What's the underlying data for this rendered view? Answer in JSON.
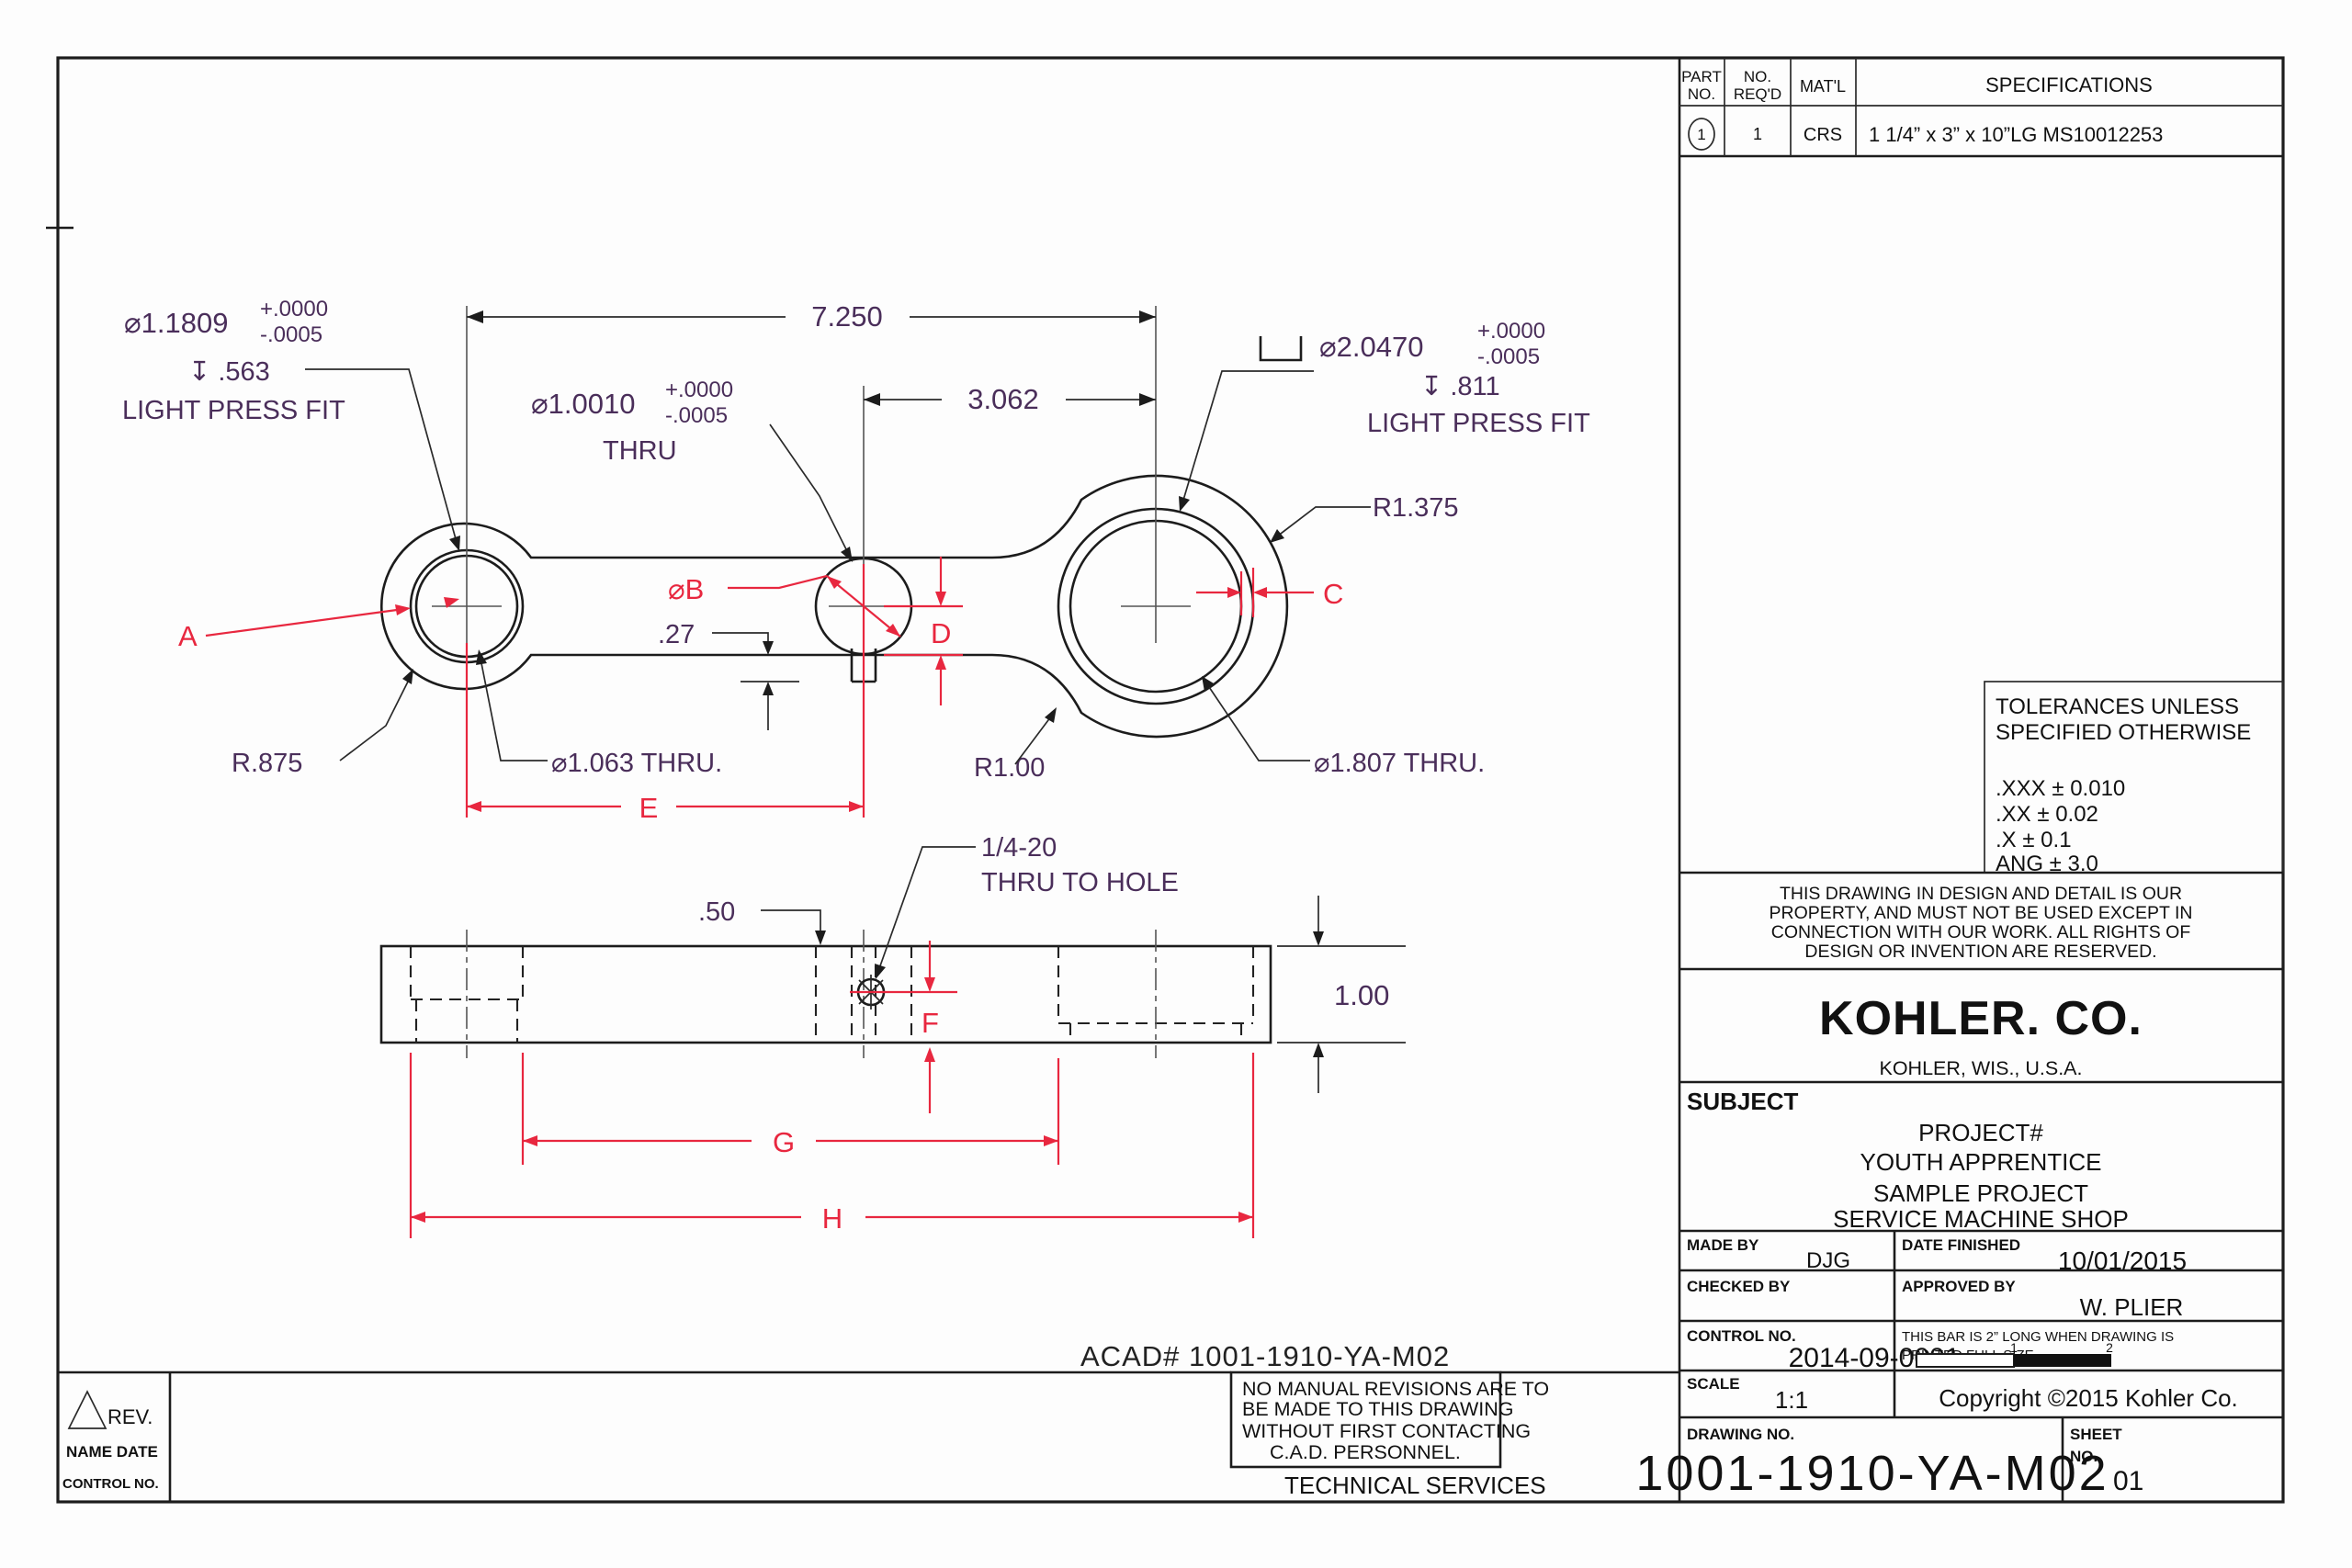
{
  "colors": {
    "dim_text": "#4a2e5a",
    "red_accent": "#e8273f",
    "line": "#1c1c1c"
  },
  "tv": {
    "d7250": "7.250",
    "d3062": "3.062",
    "bl": {
      "dia": "⌀1.1809",
      "tp": "+.0000",
      "tm": "-.0005",
      "depth": "↧ .563",
      "fit": "LIGHT PRESS FIT"
    },
    "bm": {
      "dia": "⌀1.0010",
      "tp": "+.0000",
      "tm": "-.0005",
      "thru": "THRU"
    },
    "br": {
      "dia": "⌀2.0470",
      "tp": "+.0000",
      "tm": "-.0005",
      "depth": "↧ .811",
      "fit": "LIGHT PRESS FIT"
    },
    "r1375": "R1.375",
    "r875": "R.875",
    "d1063": "⌀1.063 THRU.",
    "r100": "R1.00",
    "d1807": "⌀1.807 THRU.",
    "d27": ".27",
    "A": "A",
    "B": "⌀B",
    "C": "C",
    "D": "D",
    "E": "E"
  },
  "sv": {
    "d50": ".50",
    "th1": "1/4-20",
    "th2": "THRU TO HOLE",
    "d100": "1.00",
    "F": "F",
    "G": "G",
    "H": "H"
  },
  "pt": {
    "h1a": "PART",
    "h1b": "NO.",
    "h2a": "NO.",
    "h2b": "REQ'D",
    "h3": "MAT'L",
    "h4": "SPECIFICATIONS",
    "r1": "1",
    "r2": "1",
    "r3": "CRS",
    "r4": "1 1/4” x 3” x 10”LG MS10012253"
  },
  "tol": {
    "t1": "TOLERANCES UNLESS",
    "t2": "SPECIFIED OTHERWISE",
    "r1": ".XXX ± 0.010",
    "r2": ".XX ± 0.02",
    "r3": ".X ± 0.1",
    "r4": "ANG ± 3.0"
  },
  "note": {
    "l1": "THIS DRAWING IN DESIGN AND DETAIL IS OUR",
    "l2": "PROPERTY, AND MUST NOT BE USED EXCEPT IN",
    "l3": "CONNECTION WITH OUR WORK. ALL RIGHTS OF",
    "l4": "DESIGN OR INVENTION ARE RESERVED."
  },
  "co": {
    "logo": "KOHLER. CO.",
    "loc": "KOHLER, WIS., U.S.A."
  },
  "subj": {
    "label": "SUBJECT",
    "l1": "PROJECT#",
    "l2": "YOUTH APPRENTICE",
    "l3": "SAMPLE PROJECT",
    "l4": "SERVICE MACHINE SHOP"
  },
  "sign": {
    "made_label": "MADE BY",
    "made": "DJG",
    "datef_label": "DATE FINISHED",
    "datef": "10/01/2015",
    "checked_label": "CHECKED BY",
    "approved_label": "APPROVED BY",
    "approved": "W. PLIER",
    "control_label": "CONTROL NO.",
    "control": "2014-09-0001"
  },
  "bar": {
    "l1": "THIS BAR IS 2” LONG WHEN DRAWING IS",
    "l2": "PRINTED FULL SIZE",
    "n1": "1",
    "n2": "2"
  },
  "sc": {
    "label": "SCALE",
    "value": "1:1",
    "copyright": "Copyright ©2015  Kohler Co."
  },
  "dn": {
    "label": "DRAWING NO.",
    "value": "1001-1910-YA-M02",
    "sheet1": "SHEET",
    "sheet2": "NO.",
    "sheet": "01"
  },
  "rev": {
    "rev": "REV.",
    "name_date": "NAME DATE",
    "control": "CONTROL NO."
  },
  "strip": {
    "acad": "ACAD# 1001-1910-YA-M02",
    "nm1": "NO MANUAL REVISIONS ARE TO",
    "nm2": "BE MADE TO THIS DRAWING",
    "nm3": "WITHOUT FIRST CONTACTING",
    "nm4": "C.A.D. PERSONNEL.",
    "tech": "TECHNICAL SERVICES"
  }
}
